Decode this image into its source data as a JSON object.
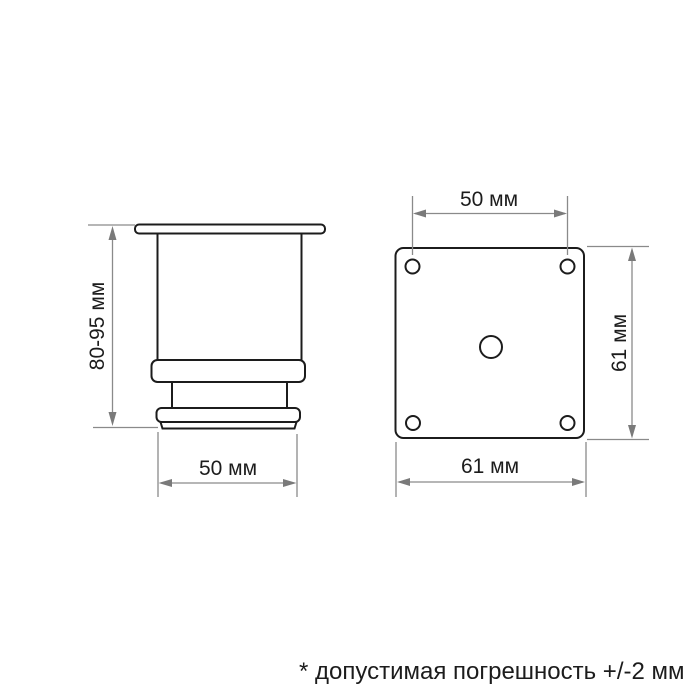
{
  "side_view": {
    "height_dim_label": "80-95 мм",
    "width_dim_label": "50 мм"
  },
  "top_view": {
    "hole_spacing_dim_label": "50 мм",
    "plate_height_dim_label": "61 мм",
    "plate_width_dim_label": "61 мм"
  },
  "footnote": "* допустимая погрешность +/-2 мм",
  "colors": {
    "outline": "#1c1c1c",
    "dimension_lines": "#8a8a8a",
    "text": "#1c1c1c",
    "background": "#ffffff"
  }
}
